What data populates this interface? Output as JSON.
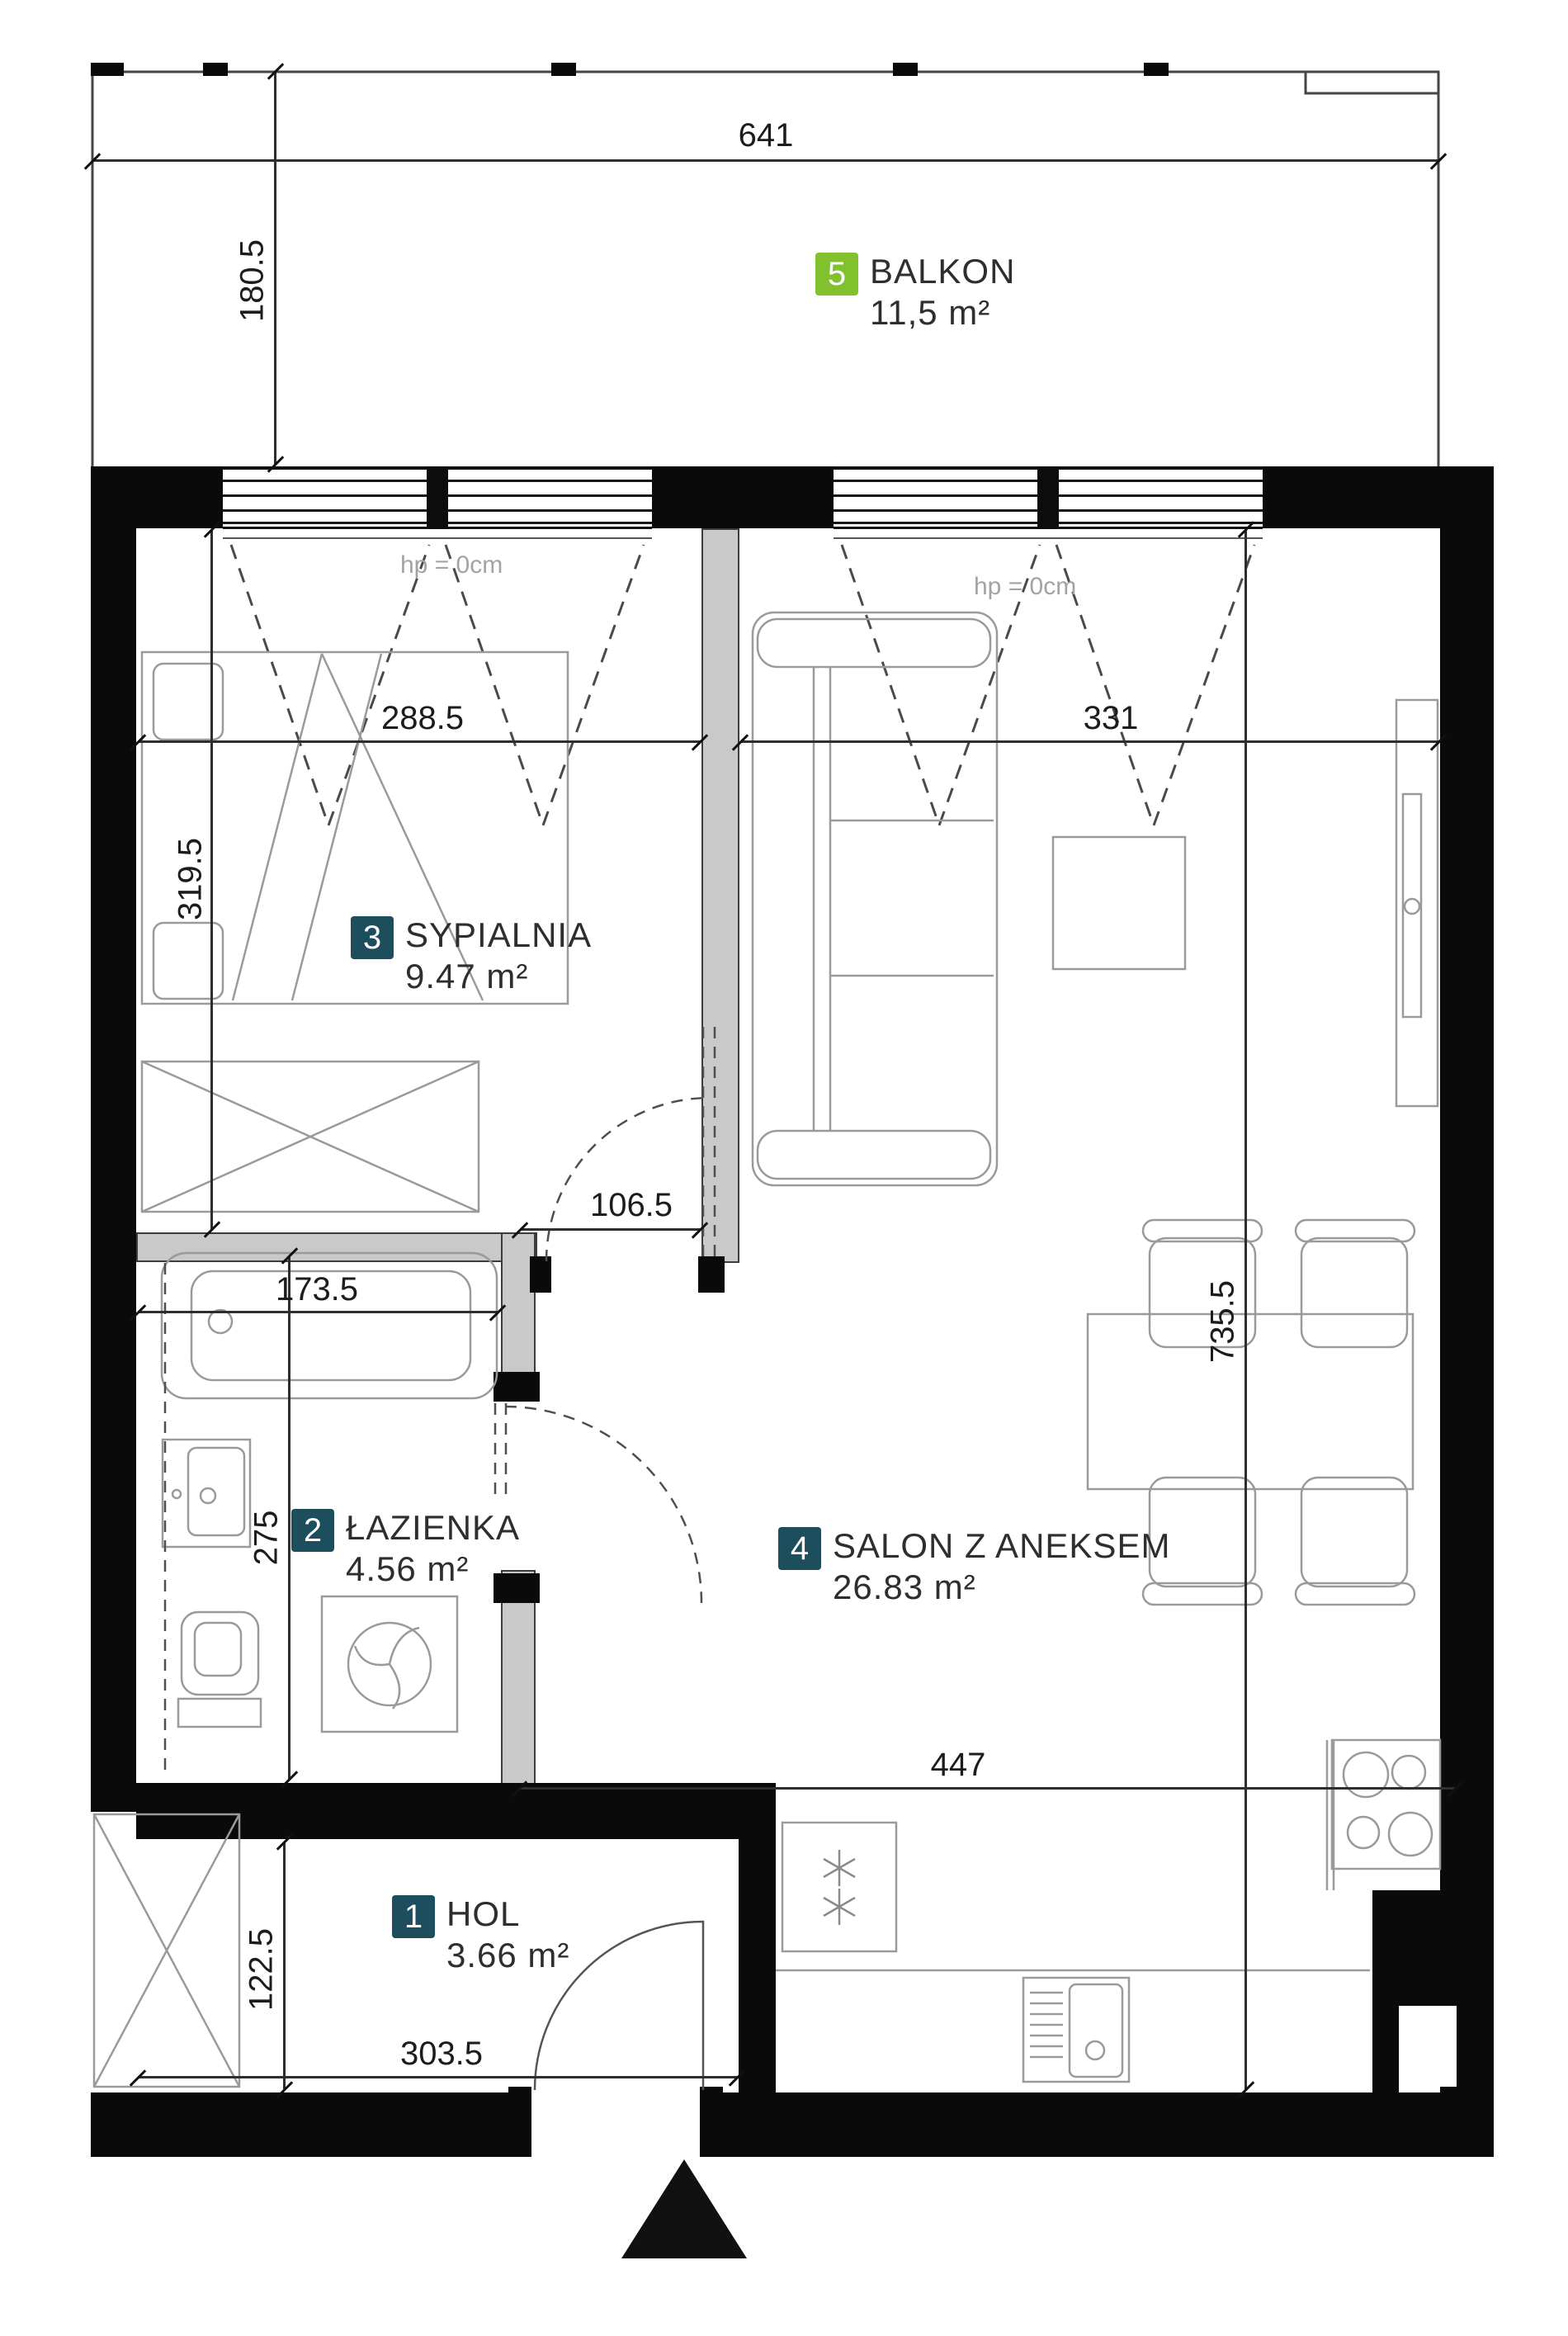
{
  "plan": {
    "rooms": [
      {
        "number": "1",
        "name": "HOL",
        "area": "3.66 m²"
      },
      {
        "number": "2",
        "name": "ŁAZIENKA",
        "area": "4.56 m²"
      },
      {
        "number": "3",
        "name": "SYPIALNIA",
        "area": "9.47 m²"
      },
      {
        "number": "4",
        "name": "SALON Z ANEKSEM",
        "area": "26.83 m²"
      },
      {
        "number": "5",
        "name": "BALKON",
        "area": "11,5 m²"
      }
    ],
    "dimensions": {
      "balcony_width": "641",
      "balcony_depth": "180.5",
      "bedroom_width": "288.5",
      "salon_width": "331",
      "bedroom_depth": "319.5",
      "bedroom_door": "106.5",
      "bathroom_width": "173.5",
      "bathroom_depth": "275",
      "salon_depth": "735.5",
      "kitchen_width": "447",
      "hall_depth": "122.5",
      "hall_width": "303.5"
    },
    "window_notes": [
      "hp = 0cm",
      "hp = 0cm"
    ],
    "colors": {
      "badge_teal": "#1d4e5d",
      "badge_green": "#82c12e",
      "wall": "#0a0a0a",
      "partition_fill": "#c9c9c9"
    }
  }
}
